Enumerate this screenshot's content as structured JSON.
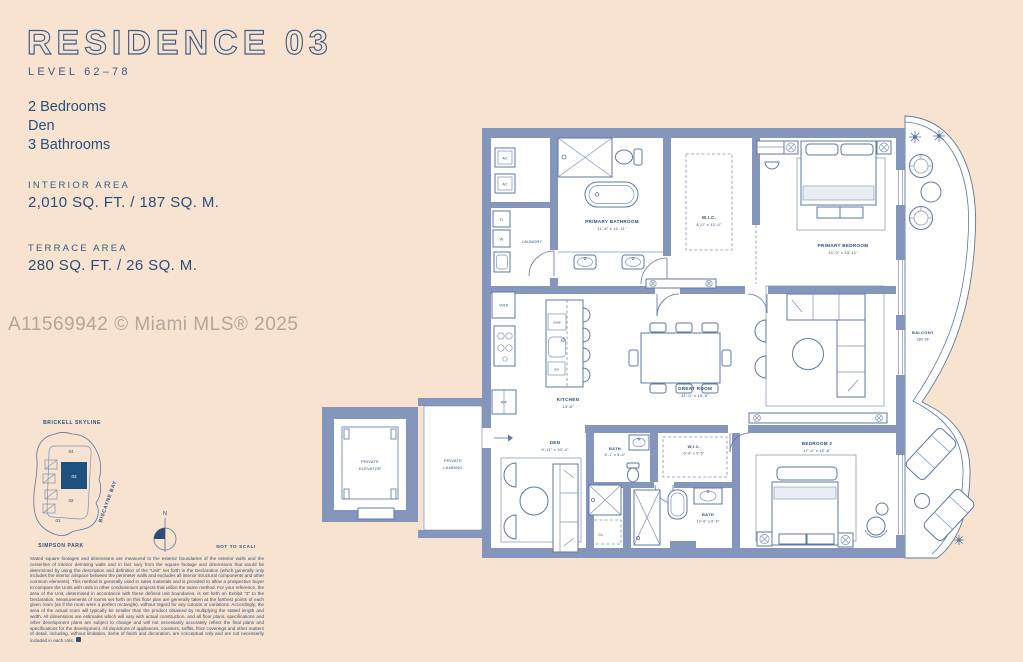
{
  "page": {
    "background": "#f8e3d0",
    "wall_color": "#8496bb",
    "line_color": "#5f77a3",
    "text_color": "#2a4e7b",
    "accent_fill": "#1d5180"
  },
  "header": {
    "title": "RESIDENCE 03",
    "level": "LEVEL 62–78",
    "features": [
      "2 Bedrooms",
      "Den",
      "3 Bathrooms"
    ]
  },
  "areas": {
    "interior_label": "INTERIOR AREA",
    "interior_value": "2,010 SQ. FT. / 187 SQ. M.",
    "terrace_label": "TERRACE AREA",
    "terrace_value": "280 SQ. FT. / 26 SQ. M."
  },
  "watermark": "A11569942 © Miami MLS® 2025",
  "keyplan": {
    "skyline": "BRICKELL SKYLINE",
    "park": "SIMPSON PARK",
    "bay": "BISCAYNE BAY",
    "units": {
      "u04": "04",
      "u03": "03",
      "u02": "02",
      "u01": "01"
    },
    "highlighted_unit": "03",
    "north": "N",
    "scale_note": "NOT TO SCALE"
  },
  "floorplan": {
    "rooms": {
      "ac1": {
        "name": "A/C"
      },
      "ac2": {
        "name": "A/C"
      },
      "dryer": {
        "name": "D"
      },
      "washer": {
        "name": "W"
      },
      "laundry": {
        "name": "LAUNDRY"
      },
      "oven": {
        "name": "OVEN"
      },
      "fridge": {
        "name": "R/F"
      },
      "wine": {
        "name": "WINE"
      },
      "dishwasher": {
        "name": "DW"
      },
      "kitchen": {
        "name": "KITCHEN",
        "dims": "13'-6\""
      },
      "primary_bathroom": {
        "name": "PRIMARY BATHROOM",
        "dims": "11'-8\" x 12'-11\""
      },
      "primary_wic": {
        "name": "W.I.C.",
        "dims": "8'-0\" x 12'-0\""
      },
      "primary_bedroom": {
        "name": "PRIMARY BEDROOM",
        "dims": "14'-0\" x 13'-11\""
      },
      "great_room": {
        "name": "GREAT ROOM",
        "dims": "41'-0\" x 15'-6\""
      },
      "den": {
        "name": "DEN",
        "dims": "9'-11\" x 10'-4\""
      },
      "bath": {
        "name": "BATH",
        "dims": "6'-1\" x 5'-4\""
      },
      "wic2": {
        "name": "W.I.C.",
        "dims": "6'-4\" x 5'-5\""
      },
      "bath2": {
        "name": "BATH",
        "dims": "10'-6\" x 6'-6\""
      },
      "closet": {
        "name": "CL"
      },
      "bedroom2": {
        "name": "BEDROOM 2",
        "dims": "17'-4\" x 12'-6\""
      },
      "balcony": {
        "name": "BALCONY",
        "dims": "280 SF"
      },
      "private_elevator": {
        "line1": "PRIVATE",
        "line2": "ELEVATOR"
      },
      "private_landing": {
        "line1": "PRIVATE",
        "line2": "LANDING"
      }
    }
  },
  "disclaimer": "Stated square footages and dimensions are measured to the exterior boundaries of the exterior walls and the centerline of interior demising walls and in fact vary from the square footage and dimensions that would be determined by using the description and definition of the \"Unit\" set forth in the Declaration (which generally only includes the interior airspace between the perimeter walls and excludes all interior structural components and other common elements). This method is generally used in sales materials and is provided to allow a prospective buyer to compare the Units with units in other condominium projects that utilize the same method. For your reference, the area of the Unit, determined in accordance with these defined unit boundaries, is set forth on Exhibit \"3\" to the Declaration. Measurements of rooms set forth on this floor plan are generally taken at the farthest points of each given room (as if the room were a perfect rectangle), without regard for any cutouts or variations. Accordingly, the area of the actual room will typically be smaller than the product obtained by multiplying the stated length and width. All dimensions are estimates which will vary with actual construction, and all floor plans, specifications and other development plans are subject to change and will not necessarily accurately reflect the final plans and specifications for the development. All depictions of appliances, counters, soffits, floor coverings and other matters of detail, including, without limitation, items of finish and decoration, are conceptual only and are not necessarily included in each Unit."
}
